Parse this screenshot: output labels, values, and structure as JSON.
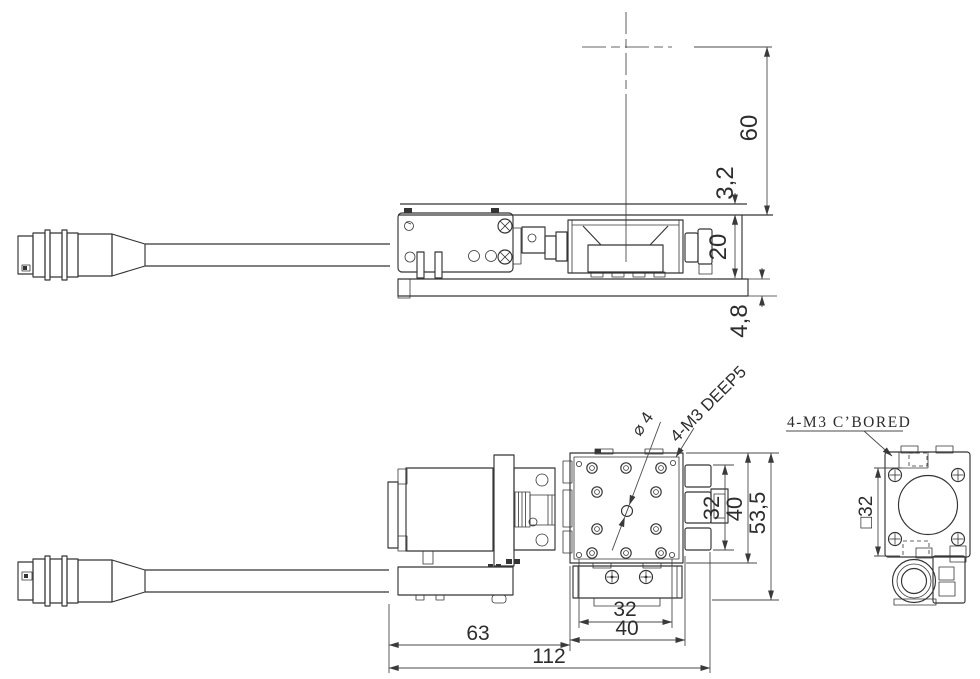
{
  "drawing": {
    "type": "mechanical-cad-three-view",
    "side_view_dims": {
      "d60": "60",
      "d3_2": "3,2",
      "d20": "20",
      "d4_8": "4,8"
    },
    "plan_view_dims_bottom": {
      "d32": "32",
      "d40": "40",
      "d63": "63",
      "d112": "112"
    },
    "plan_view_dims_right": {
      "d32": "32",
      "d40": "40",
      "d53_5": "53,5"
    },
    "end_view_dims": {
      "square32": "□32"
    },
    "callouts": {
      "phi4": "⌀ 4",
      "m3_deep5": "4-M3 DEEP5",
      "m3_cbored": "4-M3 C’BORED"
    },
    "colors": {
      "line": "#343434",
      "dim_line": "#4a4a4a",
      "text": "#2d2d2d",
      "background": "#ffffff"
    }
  }
}
